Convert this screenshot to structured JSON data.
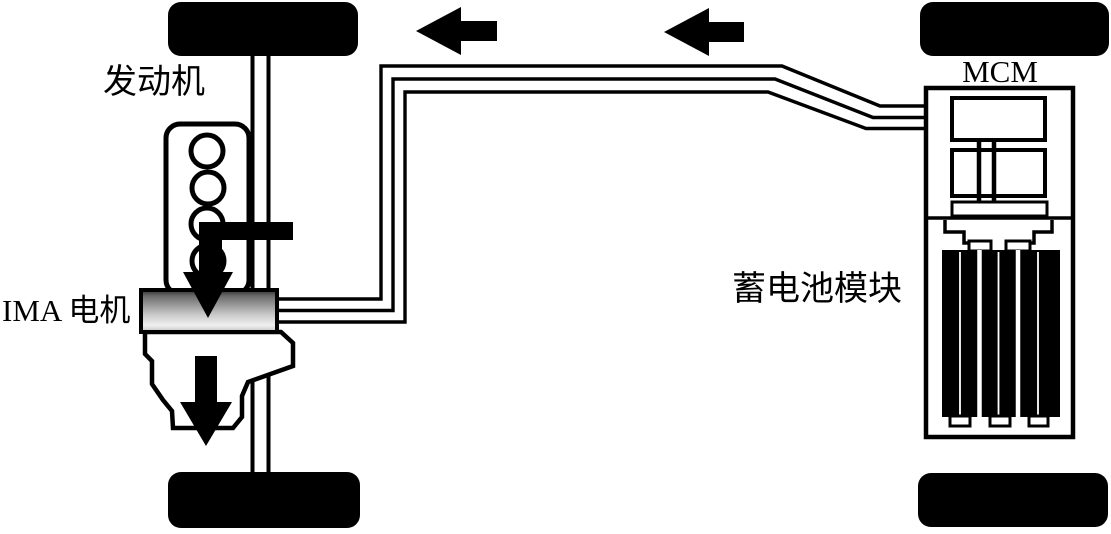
{
  "diagram": {
    "title_hint": "IMA hybrid powertrain energy-flow diagram",
    "labels": {
      "engine": "发动机",
      "ima_motor": "IMA 电机",
      "battery_module": "蓄电池模块",
      "mcm": "MCM"
    },
    "icons": {
      "flow_arrows_top": "left-arrow-icon",
      "engine_torque_arrow": "down-arrow-icon",
      "output_torque_arrow": "down-arrow-icon"
    },
    "colors": {
      "line": "#000000",
      "background": "#ffffff",
      "motor_gradient_top": "#2e2e2e",
      "motor_gradient_mid": "#c8c8c8",
      "motor_gradient_light": "#f0f0f0",
      "motor_gradient_bottom": "#c2c2c2"
    },
    "wire_bus_count": 3,
    "battery_cell_modules": 3
  }
}
